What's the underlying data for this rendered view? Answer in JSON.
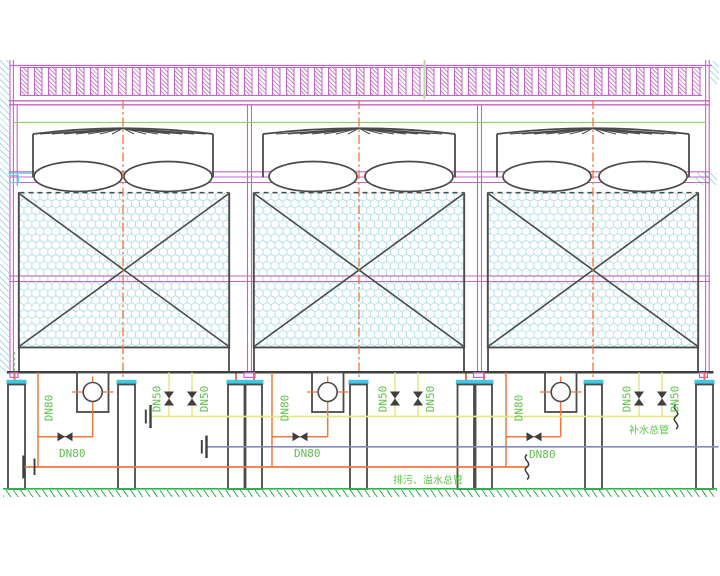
{
  "labels": {
    "dn80": "DN80",
    "dn50": "DN50",
    "makeup_water_main": "补水总管",
    "drain_overflow_main": "排污、溢水总管"
  },
  "colors": {
    "structure_purple": "#c464c4",
    "line_dark": "#3f3f3f",
    "pipe_orange": "#f0783c",
    "pipe_yellow": "#e6e68a",
    "pipe_blue": "#8686cc",
    "label_green": "#5fc148",
    "fill_hex_cyan": "#b0dfe8",
    "leg_cap_cyan": "#3cc8e6",
    "ground_green": "#2eb44e",
    "wall_hatch_blue": "#a9dce8"
  }
}
